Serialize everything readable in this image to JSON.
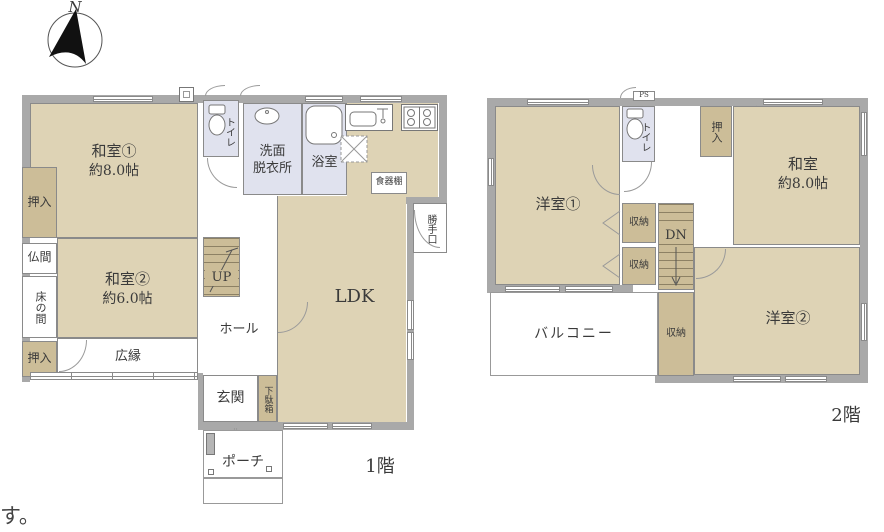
{
  "colors": {
    "tatami_fill": "#ded3b5",
    "closet_fill": "#ccbd98",
    "wet_area_fill": "#e0e2ee",
    "wall_gray": "#a9a9a9",
    "line_gray": "#8a8a8a"
  },
  "compass": {
    "label": "N"
  },
  "caption": {
    "partial_text": "す。"
  },
  "floor1": {
    "label": "1階",
    "rooms": {
      "washitsu1_line1": "和室①",
      "washitsu1_line2": "約8.0帖",
      "oshiire_top": "押入",
      "butsuma": "仏間",
      "tokonoma": "床の間",
      "oshiire_bottom": "押入",
      "washitsu2_line1": "和室②",
      "washitsu2_line2": "約6.0帖",
      "hiroen": "広縁",
      "toilet": "トイレ",
      "senmen_line1": "洗面",
      "senmen_line2": "脱衣所",
      "bath": "浴室",
      "ldk": "LDK",
      "shokkidana": "食器棚",
      "katteguchi": "勝手口",
      "hall": "ホール",
      "genkan": "玄関",
      "getabako": "下駄箱",
      "porch": "ポーチ",
      "stairs_up": "UP"
    }
  },
  "floor2": {
    "label": "2階",
    "rooms": {
      "yoshitsu1": "洋室①",
      "yoshitsu2": "洋室②",
      "washitsu_line1": "和室",
      "washitsu_line2": "約8.0帖",
      "oshiire": "押入",
      "toilet": "トイレ",
      "ps": "PS",
      "shunou_a": "収納",
      "shunou_b": "収納",
      "shunou_c": "収納",
      "stairs_dn": "DN",
      "balcony": "バルコニー"
    }
  }
}
